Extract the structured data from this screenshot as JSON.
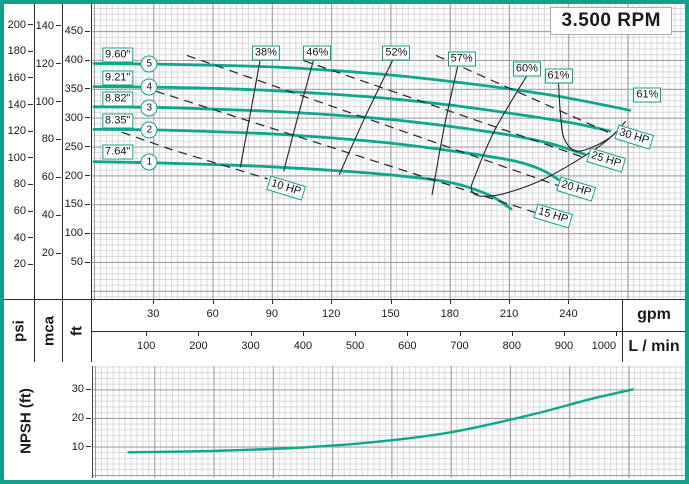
{
  "frame": {
    "rpm_label": "3.500 RPM"
  },
  "colors": {
    "teal_border": "#11A189",
    "curve_teal": "#0BA88C",
    "grid_major": "#9C9C9C",
    "grid_minor": "#D8D8D8",
    "text": "#1A1A1A"
  },
  "left_axis": {
    "psi": {
      "unit": "psi",
      "ticks": [
        200,
        180,
        160,
        140,
        120,
        100,
        80,
        60,
        40,
        20
      ],
      "ft_per_unit": 2.3067
    },
    "mca": {
      "unit": "mca",
      "ticks": [
        140,
        120,
        100,
        80,
        60,
        40,
        20
      ],
      "ft_per_unit": 3.2808
    },
    "ft": {
      "unit": "ft",
      "ticks": [
        450,
        400,
        350,
        300,
        250,
        200,
        150,
        100,
        50
      ],
      "ft_per_unit": 1
    }
  },
  "flow_axis": {
    "gpm": {
      "unit": "gpm",
      "ticks": [
        30,
        60,
        90,
        120,
        150,
        180,
        210,
        240
      ],
      "gpm_per_unit": 1
    },
    "lmin": {
      "unit": "L / min",
      "ticks": [
        100,
        200,
        300,
        400,
        500,
        600,
        700,
        800,
        900,
        1000
      ],
      "gpm_per_unit": 0.2642
    }
  },
  "npsh_axis": {
    "label": "NPSH (ft)",
    "ticks": [
      30,
      20,
      10
    ]
  },
  "chart_data": [
    {
      "type": "line",
      "title": "3.500 RPM",
      "xlabel": "gpm",
      "x2label": "L / min",
      "ylabels": [
        "psi",
        "mca",
        "ft"
      ],
      "xlim": [
        -1,
        299
      ],
      "ylim": [
        -14,
        497
      ],
      "grid": true,
      "legend_position": "none",
      "series": [
        {
          "name": "impeller-curve-5-9.60in",
          "style": "pump",
          "points": [
            [
              0,
              394
            ],
            [
              30,
              393
            ],
            [
              60,
              391
            ],
            [
              90,
              388
            ],
            [
              120,
              382
            ],
            [
              150,
              374
            ],
            [
              180,
              363
            ],
            [
              210,
              350
            ],
            [
              240,
              334
            ],
            [
              271,
              313
            ]
          ]
        },
        {
          "name": "impeller-curve-4-9.21in",
          "style": "pump",
          "points": [
            [
              0,
              354
            ],
            [
              30,
              353
            ],
            [
              60,
              351
            ],
            [
              90,
              347
            ],
            [
              120,
              341
            ],
            [
              150,
              333
            ],
            [
              180,
              322
            ],
            [
              210,
              308
            ],
            [
              240,
              292
            ],
            [
              261,
              277
            ]
          ]
        },
        {
          "name": "impeller-curve-3-8.82in",
          "style": "pump",
          "points": [
            [
              0,
              319
            ],
            [
              30,
              318
            ],
            [
              60,
              315
            ],
            [
              90,
              311
            ],
            [
              120,
              305
            ],
            [
              150,
              297
            ],
            [
              180,
              285
            ],
            [
              210,
              270
            ],
            [
              230,
              256
            ],
            [
              248,
              237
            ]
          ]
        },
        {
          "name": "impeller-curve-2-8.35in",
          "style": "pump",
          "points": [
            [
              0,
              280
            ],
            [
              30,
              279
            ],
            [
              60,
              276
            ],
            [
              90,
              272
            ],
            [
              120,
              265
            ],
            [
              150,
              256
            ],
            [
              180,
              243
            ],
            [
              210,
              227
            ],
            [
              225,
              212
            ],
            [
              235,
              193
            ]
          ]
        },
        {
          "name": "impeller-curve-1-7.64in",
          "style": "pump",
          "points": [
            [
              0,
              224
            ],
            [
              30,
              222
            ],
            [
              60,
              219
            ],
            [
              90,
              215
            ],
            [
              120,
              209
            ],
            [
              150,
              201
            ],
            [
              180,
              188
            ],
            [
              200,
              166
            ],
            [
              211,
              142
            ]
          ]
        },
        {
          "name": "efficiency-38pct",
          "style": "eff",
          "points": [
            [
              84,
              399
            ],
            [
              79,
              305
            ],
            [
              74,
              214
            ]
          ]
        },
        {
          "name": "efficiency-46pct",
          "style": "eff",
          "points": [
            [
              111,
              399
            ],
            [
              103,
              300
            ],
            [
              96,
              207
            ]
          ]
        },
        {
          "name": "efficiency-52pct",
          "style": "eff",
          "points": [
            [
              151,
              399
            ],
            [
              137,
              300
            ],
            [
              124,
              201
            ]
          ]
        },
        {
          "name": "efficiency-57pct",
          "style": "eff",
          "points": [
            [
              184,
              389
            ],
            [
              177,
              280
            ],
            [
              171,
              166
            ]
          ]
        },
        {
          "name": "efficiency-60pct",
          "style": "eff",
          "points": [
            [
              219,
              373
            ],
            [
              203,
              280
            ],
            [
              193,
              201
            ],
            [
              191,
              175
            ],
            [
              196,
              164
            ],
            [
              209,
              170
            ],
            [
              229,
              196
            ],
            [
              255,
              249
            ],
            [
              267,
              284
            ]
          ]
        },
        {
          "name": "efficiency-61pct",
          "style": "eff",
          "points": [
            [
              235,
              361
            ],
            [
              236,
              306
            ],
            [
              238,
              263
            ],
            [
              245,
              242
            ],
            [
              260,
              263
            ],
            [
              269,
              294
            ]
          ]
        },
        {
          "name": "power-10hp",
          "style": "power",
          "points": [
            [
              14,
              275
            ],
            [
              39,
              245
            ],
            [
              88,
              194
            ]
          ]
        },
        {
          "name": "power-15hp",
          "style": "power",
          "points": [
            [
              24,
              354
            ],
            [
              224,
              135
            ]
          ]
        },
        {
          "name": "power-20hp",
          "style": "power",
          "points": [
            [
              47,
              408
            ],
            [
              235,
              182
            ]
          ]
        },
        {
          "name": "power-25hp",
          "style": "power",
          "points": [
            [
              106,
              399
            ],
            [
              248,
              231
            ]
          ]
        },
        {
          "name": "power-30hp",
          "style": "power",
          "points": [
            [
              173,
              408
            ],
            [
              260,
              275
            ]
          ]
        }
      ],
      "labels": [
        {
          "text": "9.60\"",
          "x": 12,
          "y": 408,
          "cls": "diam"
        },
        {
          "text": "9.21\"",
          "x": 12,
          "y": 369,
          "cls": "diam"
        },
        {
          "text": "8.82\"",
          "x": 12,
          "y": 333,
          "cls": "diam"
        },
        {
          "text": "8.35\"",
          "x": 12,
          "y": 294,
          "cls": "diam"
        },
        {
          "text": "7.64\"",
          "x": 12,
          "y": 240,
          "cls": "diam"
        },
        {
          "text": "38%",
          "x": 87,
          "y": 413
        },
        {
          "text": "46%",
          "x": 113,
          "y": 413
        },
        {
          "text": "52%",
          "x": 153,
          "y": 413
        },
        {
          "text": "57%",
          "x": 186,
          "y": 401
        },
        {
          "text": "60%",
          "x": 219,
          "y": 385
        },
        {
          "text": "61%",
          "x": 235,
          "y": 373
        },
        {
          "text": "61%",
          "x": 280,
          "y": 340
        },
        {
          "text": "10 HP",
          "x": 97,
          "y": 179,
          "rot": 17
        },
        {
          "text": "15 HP",
          "x": 232,
          "y": 130,
          "rot": 17
        },
        {
          "text": "20 HP",
          "x": 244,
          "y": 177,
          "rot": 17
        },
        {
          "text": "25 HP",
          "x": 259,
          "y": 226,
          "rot": 17
        },
        {
          "text": "30 HP",
          "x": 273,
          "y": 266,
          "rot": 17
        }
      ],
      "markers": [
        {
          "text": "5",
          "x": 28,
          "y": 394
        },
        {
          "text": "4",
          "x": 28,
          "y": 354
        },
        {
          "text": "3",
          "x": 28,
          "y": 317
        },
        {
          "text": "2",
          "x": 28,
          "y": 278
        },
        {
          "text": "1",
          "x": 28,
          "y": 224
        }
      ]
    },
    {
      "type": "line",
      "title": "NPSH required",
      "xlabel": "gpm",
      "ylabel": "NPSH (ft)",
      "xlim": [
        -1,
        299
      ],
      "ylim": [
        -1,
        38.2
      ],
      "grid": true,
      "legend_position": "none",
      "series": [
        {
          "name": "npsh-required-curve",
          "style": "npsh",
          "points": [
            [
              17,
              8
            ],
            [
              60,
              8.5
            ],
            [
              100,
              9.5
            ],
            [
              140,
              11.5
            ],
            [
              180,
              15
            ],
            [
              220,
              21
            ],
            [
              250,
              26.5
            ],
            [
              272,
              30
            ]
          ]
        }
      ],
      "labels": [],
      "markers": []
    }
  ]
}
